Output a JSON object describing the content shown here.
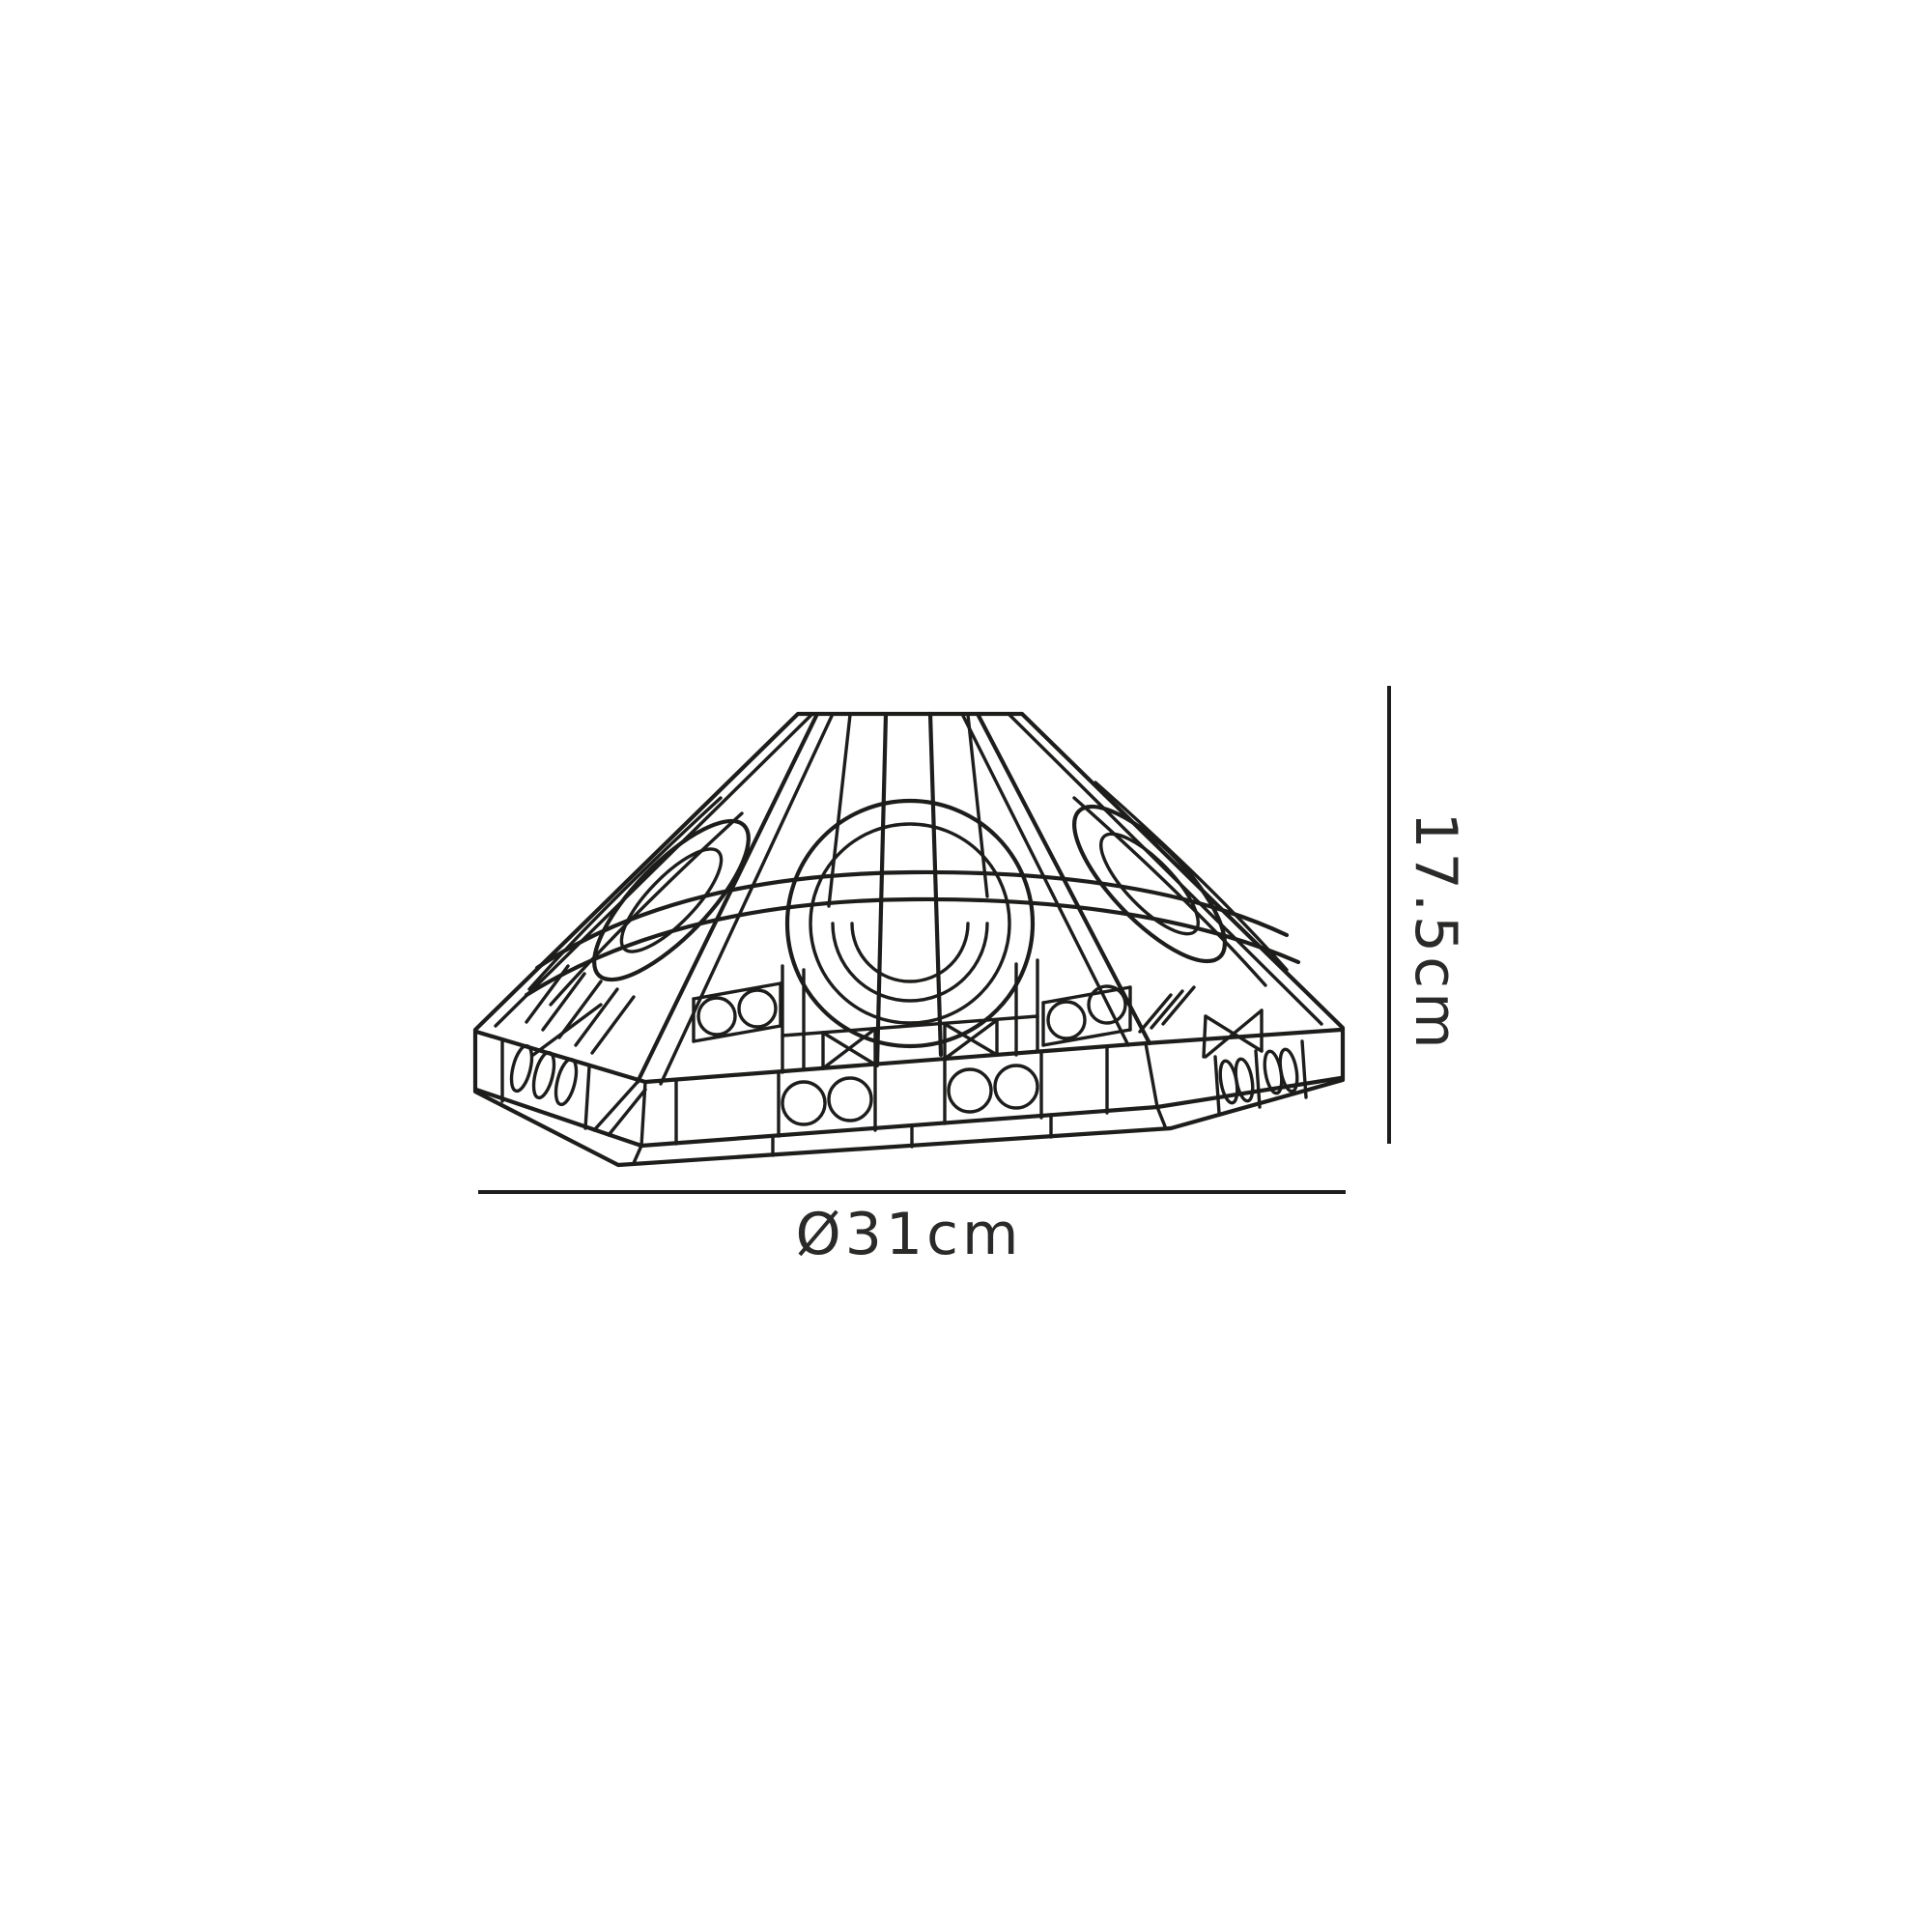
{
  "canvas": {
    "background": "#ffffff",
    "line_color": "#1d1d1b"
  },
  "drawing": {
    "description": "Octagonal art-deco (Tiffany style) lampshade, wireframe technical line drawing with circle, ellipse and cross leadline motifs"
  },
  "dimension_annotations": {
    "diameter": {
      "label": "Ø31cm"
    },
    "height": {
      "label": "17.5cm"
    }
  }
}
